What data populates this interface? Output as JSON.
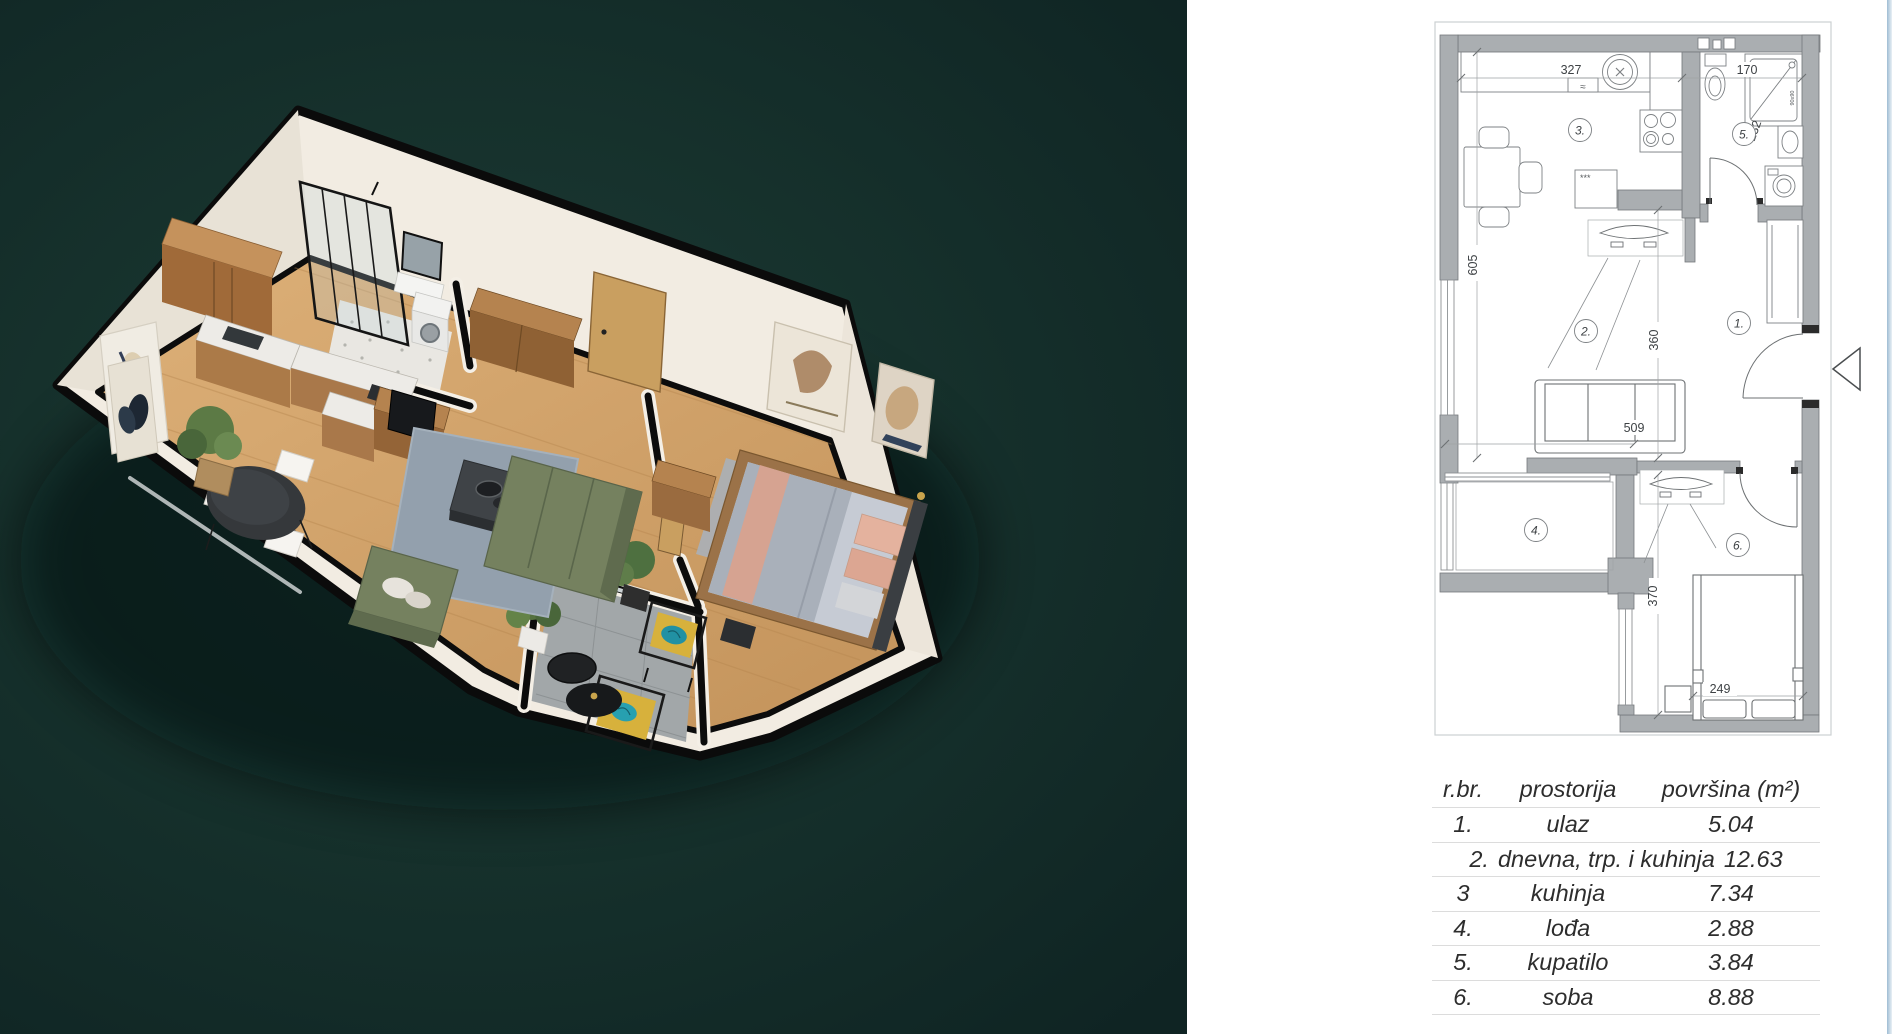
{
  "area_table": {
    "headers": [
      "r.br.",
      "prostorija",
      "površina (m²)"
    ],
    "rows": [
      [
        "1.",
        "ulaz",
        "5.04"
      ],
      [
        "2.",
        "dnevna, trp. i kuhinja",
        "12.63"
      ],
      [
        "3",
        "kuhinja",
        "7.34"
      ],
      [
        "4.",
        "lođa",
        "2.88"
      ],
      [
        "5.",
        "kupatilo",
        "3.84"
      ],
      [
        "6.",
        "soba",
        "8.88"
      ]
    ]
  },
  "floorplan": {
    "rooms": {
      "r1": "1.",
      "r2": "2.",
      "r3": "3.",
      "r4": "4.",
      "r5": "5.",
      "r6": "6."
    },
    "dims": {
      "kitchen_width": "327",
      "bath_width": "170",
      "left_height": "605",
      "bath_height": "232",
      "living_height": "360",
      "living_width": "509",
      "bedroom_height": "370",
      "bed_width": "249",
      "shower_size": "90x90",
      "fridge_mark": "***",
      "sink_mark": "≈"
    }
  },
  "render": {
    "description": "3D isometric apartment render",
    "colors": {
      "background_green": "#16312c",
      "wall": "#f2ece2",
      "wall_top": "#0b0b0b",
      "wood_floor": "#d4a56c",
      "rug": "#93a0ad",
      "sofa_green": "#75815f",
      "balcony_cushion": "#d7b13c",
      "pillow_pink": "#e4b29e"
    }
  }
}
